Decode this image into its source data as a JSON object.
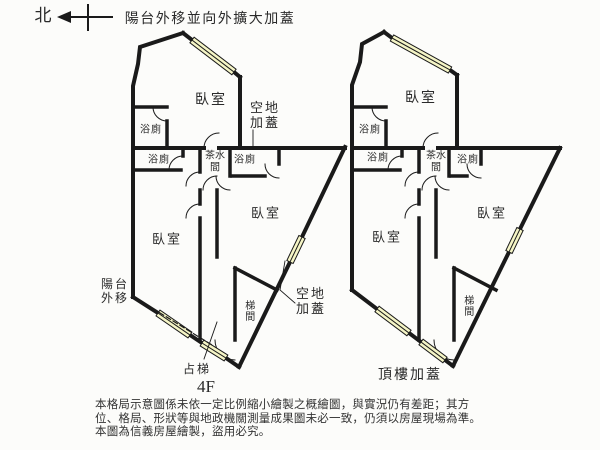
{
  "header": {
    "north": "北",
    "title": "陽台外移並向外擴大加蓋"
  },
  "colors": {
    "wall": "#1a1a1a",
    "window_fill": "#f5f5c6",
    "background": "#fcfcfa",
    "text": "#2a2a2a"
  },
  "left": {
    "bedroom_top": "臥室",
    "bath1": "浴廁",
    "bath2": "浴廁",
    "tea1": "茶水",
    "tea2": "間",
    "bath3": "浴廁",
    "open_top1": "空地",
    "open_top2": "加蓋",
    "bedroom_bl": "臥室",
    "bedroom_br": "臥室",
    "stair": "梯間",
    "balcony1": "陽台",
    "balcony2": "外移",
    "open_bot1": "空地",
    "open_bot2": "加蓋",
    "steal_stairs": "占梯",
    "floor": "4F"
  },
  "right": {
    "bedroom_top": "臥室",
    "bath1": "浴廁",
    "bath2": "浴廁",
    "tea1": "茶水",
    "tea2": "間",
    "bath3": "浴廁",
    "bedroom_bl": "臥室",
    "bedroom_br": "臥室",
    "stair": "梯間",
    "rooftop": "頂樓加蓋"
  },
  "footer": {
    "line1": "本格局示意圖係未依一定比例縮小繪製之概繪圖，與實況仍有差距；其方",
    "line2": "位、格局、形狀等與地政機關測量成果圖未必一致，仍須以房屋現場為準。",
    "line3": "本圖為信義房屋繪製，盜用必究。"
  }
}
